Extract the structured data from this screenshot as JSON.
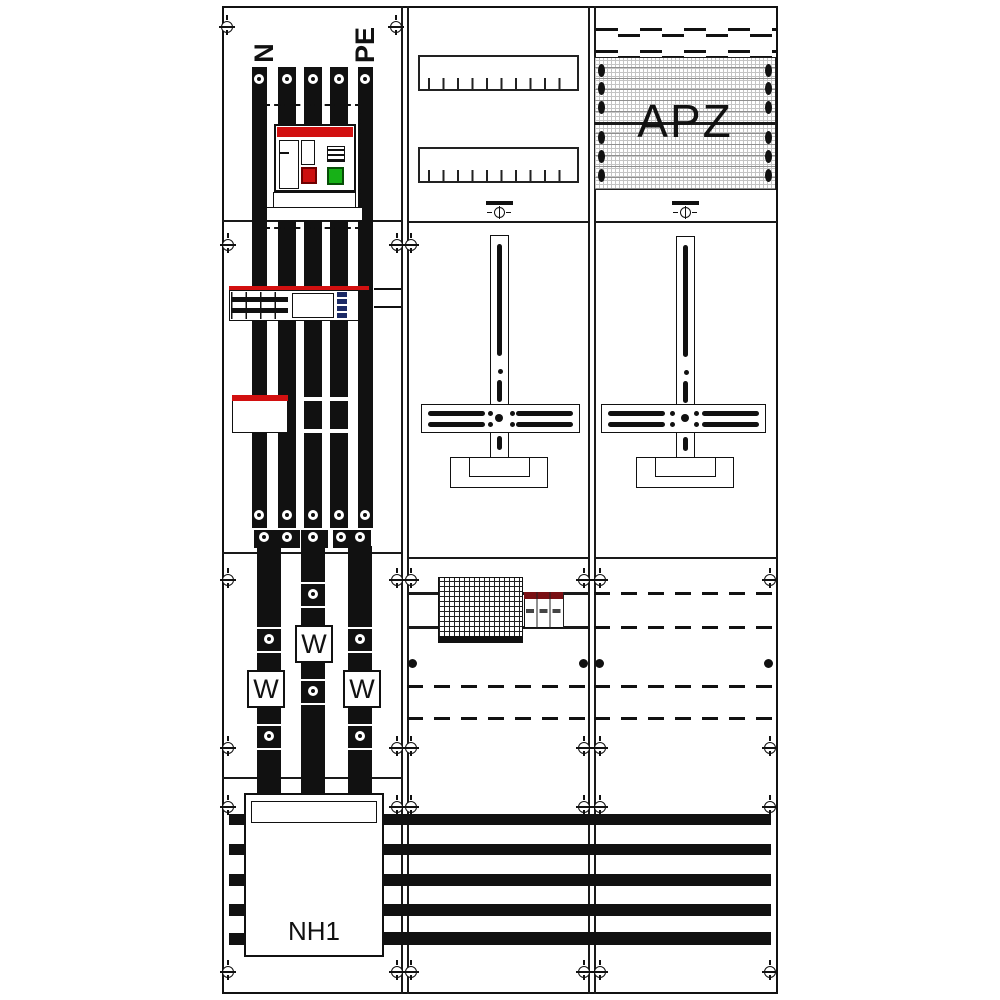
{
  "drawing": {
    "labels": {
      "busbar_n": "N",
      "busbar_pe": "PE",
      "apz": "APZ",
      "nh1": "NH1"
    }
  },
  "meters": [
    {
      "label": "W"
    },
    {
      "label": "W"
    },
    {
      "label": "W"
    }
  ],
  "icons": {
    "screw": "screw-head-icon",
    "fixing_point": "fixing-point-icon",
    "busbar_hole": "busbar-hole-icon"
  },
  "colors": {
    "line": "#1a1a1a",
    "busbar_red": "#d21010",
    "indicator_red": "#cc0f0f",
    "indicator_green": "#17b117",
    "module_dark_red": "#7a1014",
    "connector_blue": "#1b2a66",
    "hatch_gray": "#bdbdbd"
  }
}
